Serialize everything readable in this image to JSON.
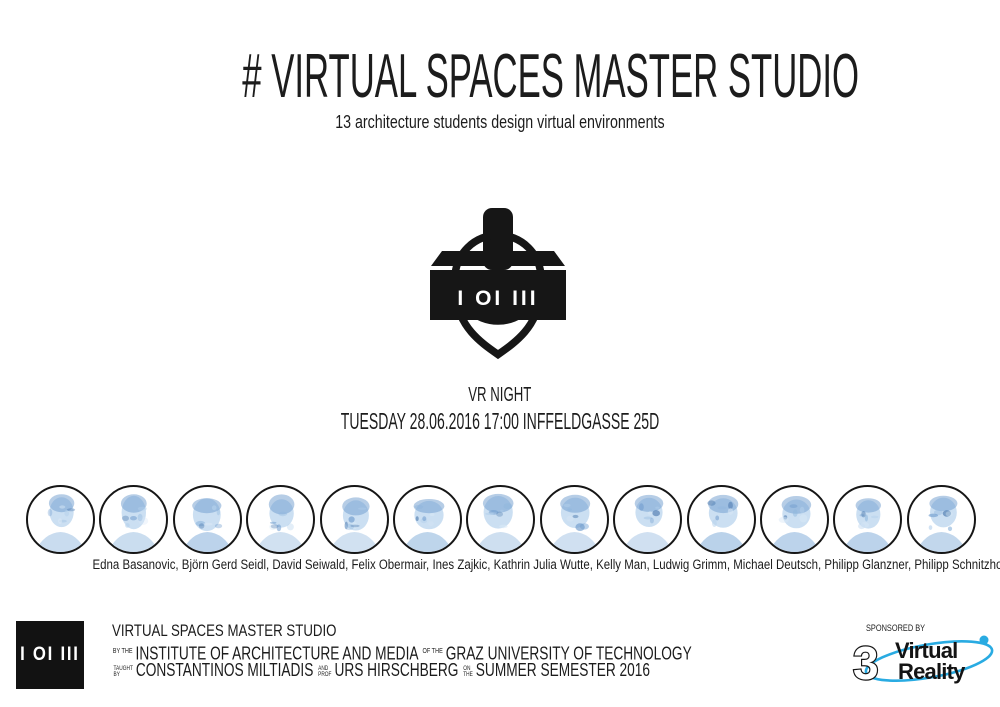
{
  "poster": {
    "title": "# VIRTUAL SPACES MASTER STUDIO",
    "subtitle": "13 architecture students design virtual environments"
  },
  "headset_logo": {
    "band_label": "I OI III"
  },
  "event": {
    "name": "VR NIGHT",
    "details": "TUESDAY 28.06.2016 17:00 INFFELDGASSE 25D"
  },
  "students": {
    "credits_line": "Edna Basanovic, Björn Gerd Seidl, David Seiwald, Felix Obermair, Ines Zajkic, Kathrin Julia Wutte, Kelly Man, Ludwig Grimm, Michael Deutsch, Philipp Glanzner, Philipp Schnitzhofer, Primoz Brglez, Xin Guo",
    "names": [
      "Edna Basanovic",
      "Björn Gerd Seidl",
      "David Seiwald",
      "Felix Obermair",
      "Ines Zajkic",
      "Kathrin Julia Wutte",
      "Kelly Man",
      "Ludwig Grimm",
      "Michael Deutsch",
      "Philipp Glanzner",
      "Philipp Schnitzhofer",
      "Primoz Brglez",
      "Xin Guo"
    ]
  },
  "footer": {
    "logo_label": "I OI III",
    "studio_name": "VIRTUAL SPACES MASTER STUDIO",
    "by_the": "BY THE",
    "institute": "INSTITUTE OF ARCHITECTURE AND MEDIA",
    "of_the": "OF THE",
    "university": "GRAZ UNIVERSITY OF TECHNOLOGY",
    "taught": "TAUGHT",
    "by": "BY",
    "teacher_1": "CONSTANTINOS MILTIADIS",
    "and": "AND",
    "prof": "PROF",
    "teacher_2": "URS HIRSCHBERG",
    "on": "ON",
    "the": "THE",
    "semester": "SUMMER SEMESTER 2016"
  },
  "sponsor": {
    "label": "SPONSORED BY",
    "three_glyph": "3",
    "name_line1": "Virtual",
    "name_line2": "Reality",
    "accent_color": "#29abe2"
  },
  "colors": {
    "ink": "#1c1c1c",
    "portrait_sketch_blue": "#8fb6dd"
  }
}
